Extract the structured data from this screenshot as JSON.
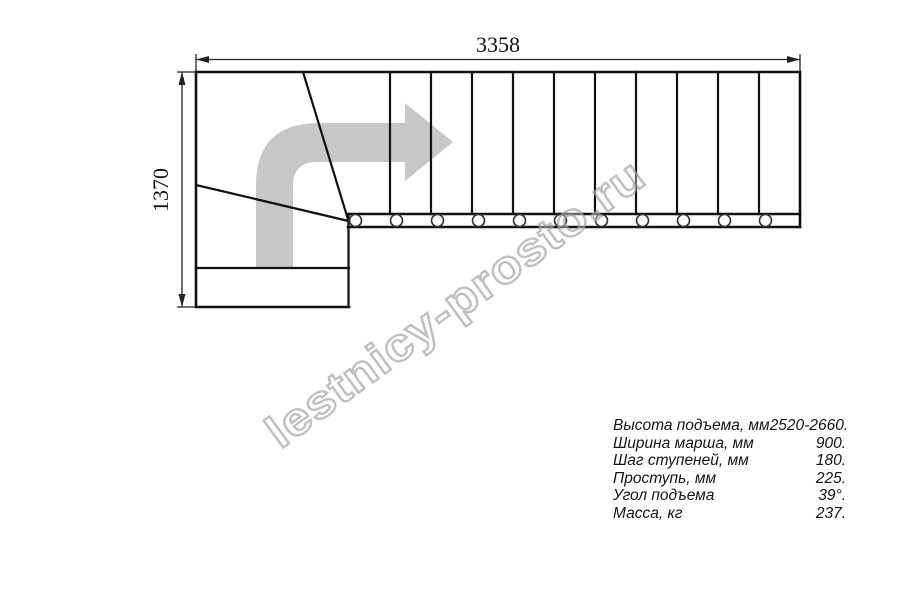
{
  "drawing": {
    "width_label": "3358",
    "height_label": "1370"
  },
  "watermark": {
    "text": "lestnicy-prosto.ru"
  },
  "specs": {
    "rows": [
      {
        "label": "Высота подъема, мм",
        "value": "2520-2660."
      },
      {
        "label": "Ширина марша, мм",
        "value": "900."
      },
      {
        "label": "Шаг ступеней, мм",
        "value": "180."
      },
      {
        "label": "Проступь, мм",
        "value": "225."
      },
      {
        "label": "Угол подъема",
        "value": "39°."
      },
      {
        "label": "Масса, кг",
        "value": "237."
      }
    ]
  },
  "colors": {
    "line": "#111111",
    "dimension": "#222222",
    "direction_arrow": "#c7c7c7",
    "watermark_stroke": "#9a9a9a"
  }
}
